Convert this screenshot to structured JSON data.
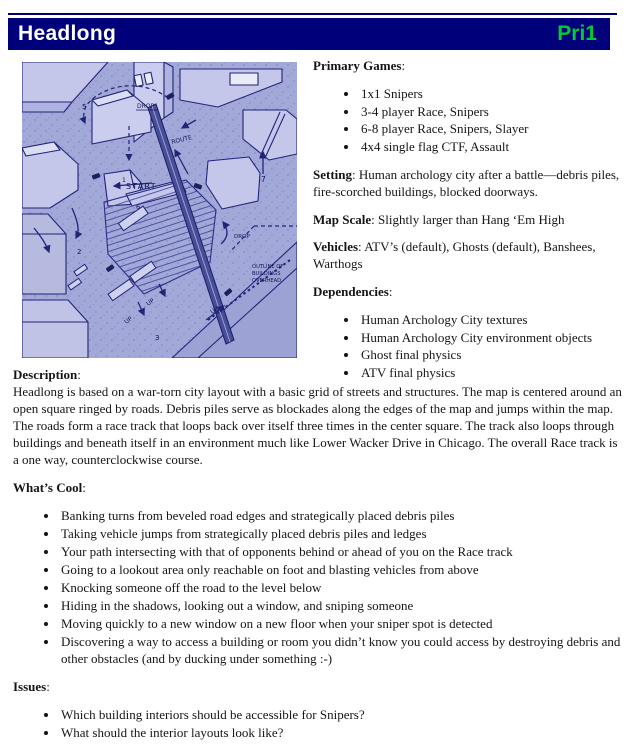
{
  "header": {
    "title": "Headlong",
    "priority": "Pri1",
    "colors": {
      "bar": "#00007a",
      "title": "#ffffff",
      "priority": "#00cc33"
    }
  },
  "ui": {
    "colon": ":"
  },
  "map": {
    "colors": {
      "base": "#a2a8d8",
      "building": "#c4c7e9",
      "building_light": "#dbdef2",
      "outline": "#23237a",
      "ink": "#14145a"
    },
    "labels": {
      "start": "START",
      "route": "ROUTE",
      "drop_top": "DROP",
      "drop_right": "DROP",
      "up_1": "UP",
      "up_2": "UP",
      "up_3": "UP",
      "overhead_1": "OUTLINE OF",
      "overhead_2": "BUILDINGS",
      "overhead_3": "OVERHEAD",
      "n1": "1",
      "n2": "2",
      "n3": "3",
      "n5": "5",
      "n6": "6",
      "n7": "7"
    }
  },
  "info": {
    "primary_games_label": "Primary Games",
    "primary_games": [
      "1x1 Snipers",
      "3-4 player Race, Snipers",
      "6-8 player Race, Snipers, Slayer",
      "4x4 single flag CTF, Assault"
    ],
    "setting_label": "Setting",
    "setting_text": "Human archology city after a battle—debris piles, fire-scorched buildings, blocked doorways.",
    "map_scale_label": "Map Scale",
    "map_scale_text": "Slightly larger than Hang ‘Em High",
    "vehicles_label": "Vehicles",
    "vehicles_text": "ATV’s (default), Ghosts (default), Banshees, Warthogs",
    "dependencies_label": "Dependencies",
    "dependencies": [
      "Human Archology City textures",
      "Human Archology City environment objects",
      "Ghost final physics",
      "ATV final physics"
    ]
  },
  "description": {
    "label": "Description",
    "text": "Headlong is based on a war-torn city layout with a basic grid of streets and structures. The map is centered around an open square ringed by roads. Debris piles serve as blockades along the edges of the map and jumps within the map. The roads form a race track that loops back over itself three times in the center square. The track also loops through buildings and beneath itself in an environment much like Lower Wacker Drive in Chicago. The overall Race track is a one way, counterclockwise course."
  },
  "whats_cool": {
    "label": "What’s Cool",
    "items": [
      "Banking turns from beveled road edges and strategically placed debris piles",
      "Taking vehicle jumps from strategically placed debris piles and ledges",
      "Your path intersecting with that of opponents behind or ahead of you on the Race track",
      "Going to a lookout area only reachable on foot and blasting vehicles from above",
      "Knocking someone off the road to the level below",
      "Hiding in the shadows, looking out a window, and sniping someone",
      "Moving quickly to a new window on a new floor when your sniper spot is detected",
      "Discovering a way to access a building or room you didn’t know you could access by destroying debris and other obstacles (and by ducking under something :-)"
    ]
  },
  "issues": {
    "label": "Issues",
    "items": [
      "Which building interiors should be accessible for Snipers?",
      "What should the interior layouts look like?"
    ]
  }
}
